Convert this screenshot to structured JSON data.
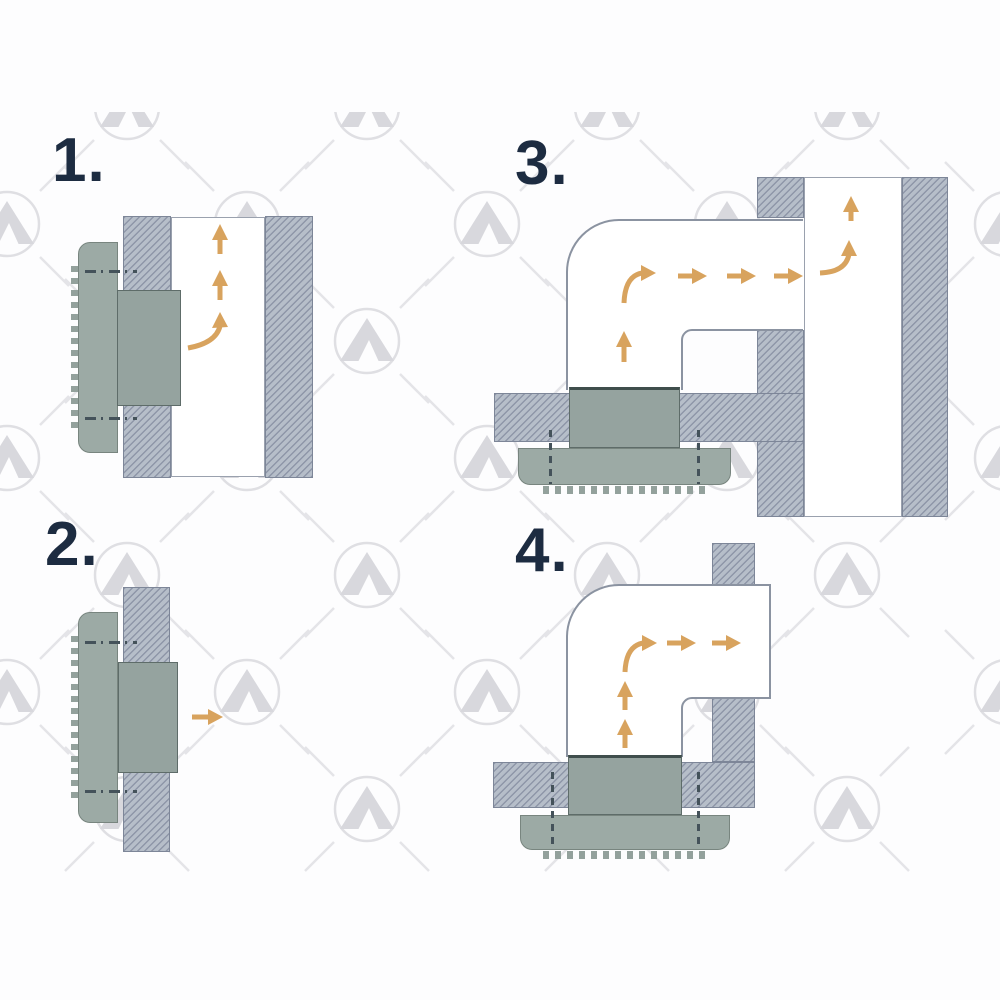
{
  "diagram": {
    "type": "installation-instruction-sheet",
    "subject": "wall and ceiling vent with duct airflow, 4 mounting variants",
    "panels": [
      {
        "label": "1.",
        "scene": "wall-mounted vent feeding a vertical in-wall duct, airflow curves up"
      },
      {
        "label": "2.",
        "scene": "wall-mounted vent blowing straight out, airflow right"
      },
      {
        "label": "3.",
        "scene": "ceiling-mounted vent with elbow duct into a vertical shaft, airflow up, right, then up"
      },
      {
        "label": "4.",
        "scene": "ceiling-mounted vent with elbow duct through a wall, airflow up then right"
      }
    ],
    "colors": {
      "background": "#fdfdfe",
      "step_label": "#1d2c41",
      "airflow_arrow": "#d8a35e",
      "wall_fill": "#b6bec9",
      "wall_hatch_line": "#8e96a8",
      "vent_grille": "#9caaa5",
      "vent_connector": "#95a39f",
      "duct_outline": "#8b93a1",
      "watermark": "#dfdfe3"
    },
    "watermark_icon": "mountain-in-circle-logo"
  }
}
